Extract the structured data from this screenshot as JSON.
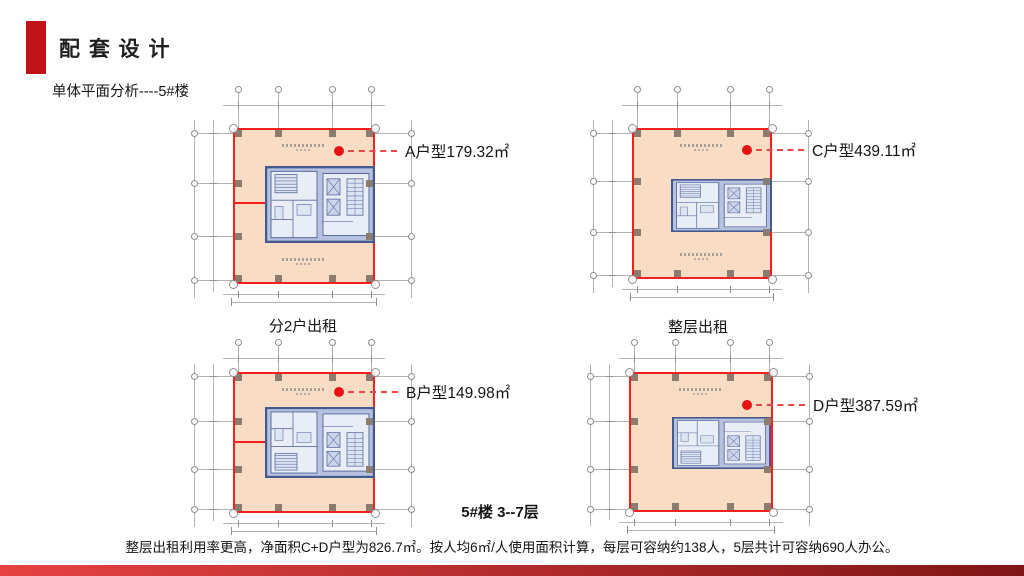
{
  "header": {
    "accent_color": "#c01418",
    "title": "配 套 设 计",
    "subtitle": "单体平面分析----5#楼"
  },
  "palette": {
    "floor_fill": "#f8dcc4",
    "floor_border": "#f52020",
    "core_fill": "#b6c2df",
    "core_border": "#46598e",
    "core_line": "#5d6ea2",
    "grid_color": "#b3b3b3",
    "tick_color": "#8f8f8f",
    "column_color": "#8a7c6e",
    "dot_color": "#e81212",
    "leader_color": "#e84848",
    "text_color": "#141414"
  },
  "plans": [
    {
      "id": "A",
      "label": "A户型179.32㎡",
      "square": {
        "x": 233,
        "y": 128,
        "w": 142,
        "h": 156
      },
      "core": {
        "x": 265,
        "y": 166,
        "w": 110,
        "h": 77
      },
      "divider_y": 203,
      "dot": {
        "x": 339,
        "y": 151
      },
      "label_x": 405,
      "top_ext": 36,
      "notes": 2,
      "flip_core": false
    },
    {
      "id": "C",
      "label": "C户型439.11㎡",
      "square": {
        "x": 632,
        "y": 128,
        "w": 140,
        "h": 151
      },
      "core": {
        "x": 671,
        "y": 179,
        "w": 101,
        "h": 53
      },
      "divider_y": null,
      "dot": {
        "x": 747,
        "y": 150
      },
      "label_x": 812,
      "top_ext": 36,
      "notes": 2,
      "flip_core": false
    },
    {
      "id": "B",
      "label": "B户型149.98㎡",
      "square": {
        "x": 233,
        "y": 372,
        "w": 142,
        "h": 141
      },
      "core": {
        "x": 265,
        "y": 407,
        "w": 110,
        "h": 71
      },
      "divider_y": 442,
      "dot": {
        "x": 339,
        "y": 392
      },
      "label_x": 406,
      "top_ext": 27,
      "notes": 1,
      "flip_core": true
    },
    {
      "id": "D",
      "label": "D户型387.59㎡",
      "square": {
        "x": 629,
        "y": 372,
        "w": 144,
        "h": 140
      },
      "core": {
        "x": 672,
        "y": 417,
        "w": 99,
        "h": 52
      },
      "divider_y": null,
      "dot": {
        "x": 747,
        "y": 405
      },
      "label_x": 813,
      "top_ext": 27,
      "notes": 1,
      "flip_core": true
    }
  ],
  "captions": [
    {
      "text": "分2户出租",
      "cx": 303,
      "cy": 325
    },
    {
      "text": "整层出租",
      "cx": 698,
      "cy": 326
    }
  ],
  "floor_range_label": {
    "text": "5#楼  3--7层",
    "cx": 500,
    "cy": 511
  },
  "footer_note": "整层出租利用率更高，净面积C+D户型为826.7㎡。按人均6㎡/人使用面积计算，每层可容纳约138人，5层共计可容纳690人办公。",
  "bottom_bar": {
    "gradient_from": "#e64242",
    "gradient_to": "#801517"
  }
}
